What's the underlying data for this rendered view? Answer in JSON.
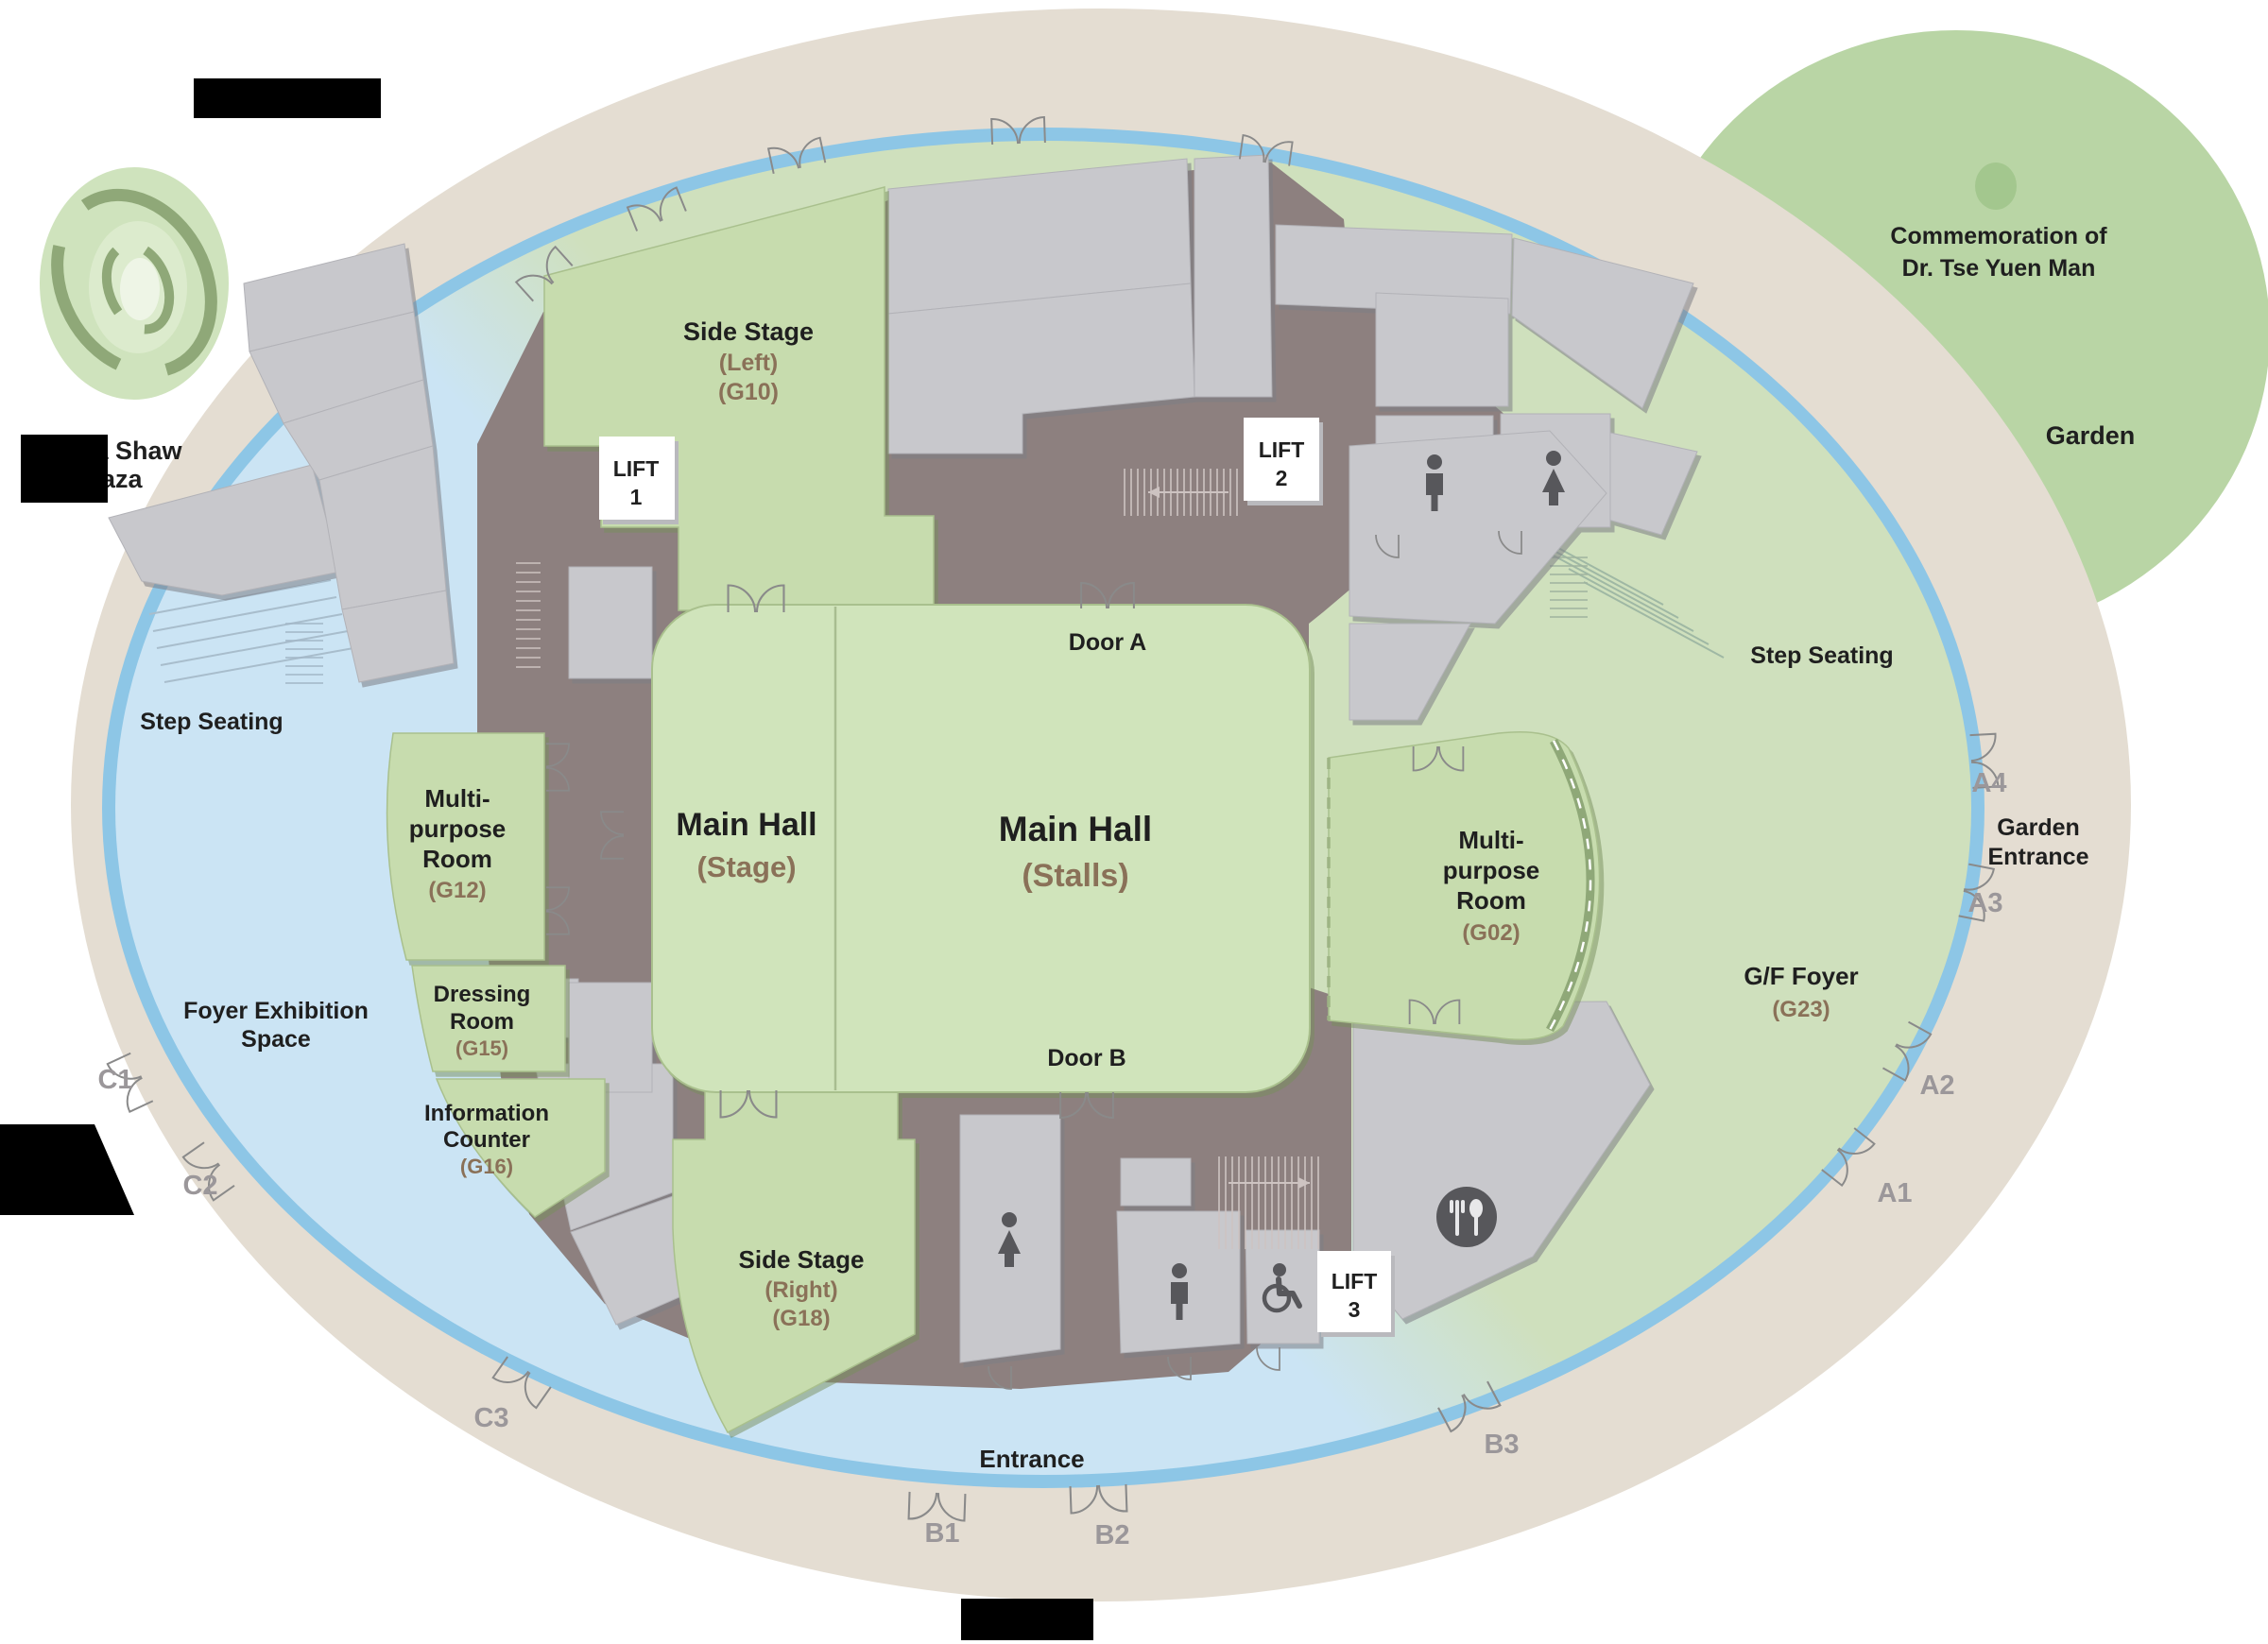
{
  "map": {
    "labels": {
      "plaza": [
        "a Shaw",
        "Plaza"
      ],
      "garden_title": [
        "Commemoration of",
        "Dr. Tse Yuen Man"
      ],
      "garden": "Garden",
      "garden_entrance": [
        "Garden",
        "Entrance"
      ],
      "side_stage_left": [
        "Side Stage",
        "(Left)",
        "(G10)"
      ],
      "side_stage_right": [
        "Side Stage",
        "(Right)",
        "(G18)"
      ],
      "main_hall_stage": [
        "Main Hall",
        "(Stage)"
      ],
      "main_hall_stalls": [
        "Main Hall",
        "(Stalls)"
      ],
      "multipurpose_g12": [
        "Multi-",
        "purpose",
        "Room",
        "(G12)"
      ],
      "multipurpose_g02": [
        "Multi-",
        "purpose",
        "Room",
        "(G02)"
      ],
      "dressing_room": [
        "Dressing",
        "Room",
        "(G15)"
      ],
      "information_counter": [
        "Information",
        "Counter",
        "(G16)"
      ],
      "gf_foyer": [
        "G/F Foyer",
        "(G23)"
      ],
      "foyer_exhibition": [
        "Foyer Exhibition",
        "Space"
      ],
      "step_seating_left": "Step Seating",
      "step_seating_right": "Step Seating",
      "door_a": "Door A",
      "door_b": "Door B",
      "entrance": "Entrance",
      "lift1": [
        "LIFT",
        "1"
      ],
      "lift2": [
        "LIFT",
        "2"
      ],
      "lift3": [
        "LIFT",
        "3"
      ]
    },
    "exits": {
      "a1": "A1",
      "a2": "A2",
      "a3": "A3",
      "a4": "A4",
      "b1": "B1",
      "b2": "B2",
      "b3": "B3",
      "c1": "C1",
      "c2": "C2",
      "c3": "C3"
    },
    "icons": {
      "male_toilet": "male-toilet-icon",
      "female_toilet": "female-toilet-icon",
      "accessible_toilet": "accessible-toilet-icon",
      "restaurant": "restaurant-icon",
      "garden_tree": "tree-icon"
    },
    "colors": {
      "outer_ring_tan": "#e4ddd2",
      "glass_band_blue": "#8dc6e6",
      "foyer_blue": "#cbe4f4",
      "foyer_green": "#cfe0bd",
      "room_green": "#c7dcae",
      "hall_green": "#d0e4bb",
      "room_gray": "#c8c8cc",
      "circulation_brown": "#8d807f",
      "garden_green": "#b9d5a5",
      "icon_gray": "#57575b",
      "label_black": "#1f1f1f",
      "room_code_brown": "#8a7158",
      "exit_label_gray": "#9b979a",
      "redaction_black": "#000000"
    }
  }
}
